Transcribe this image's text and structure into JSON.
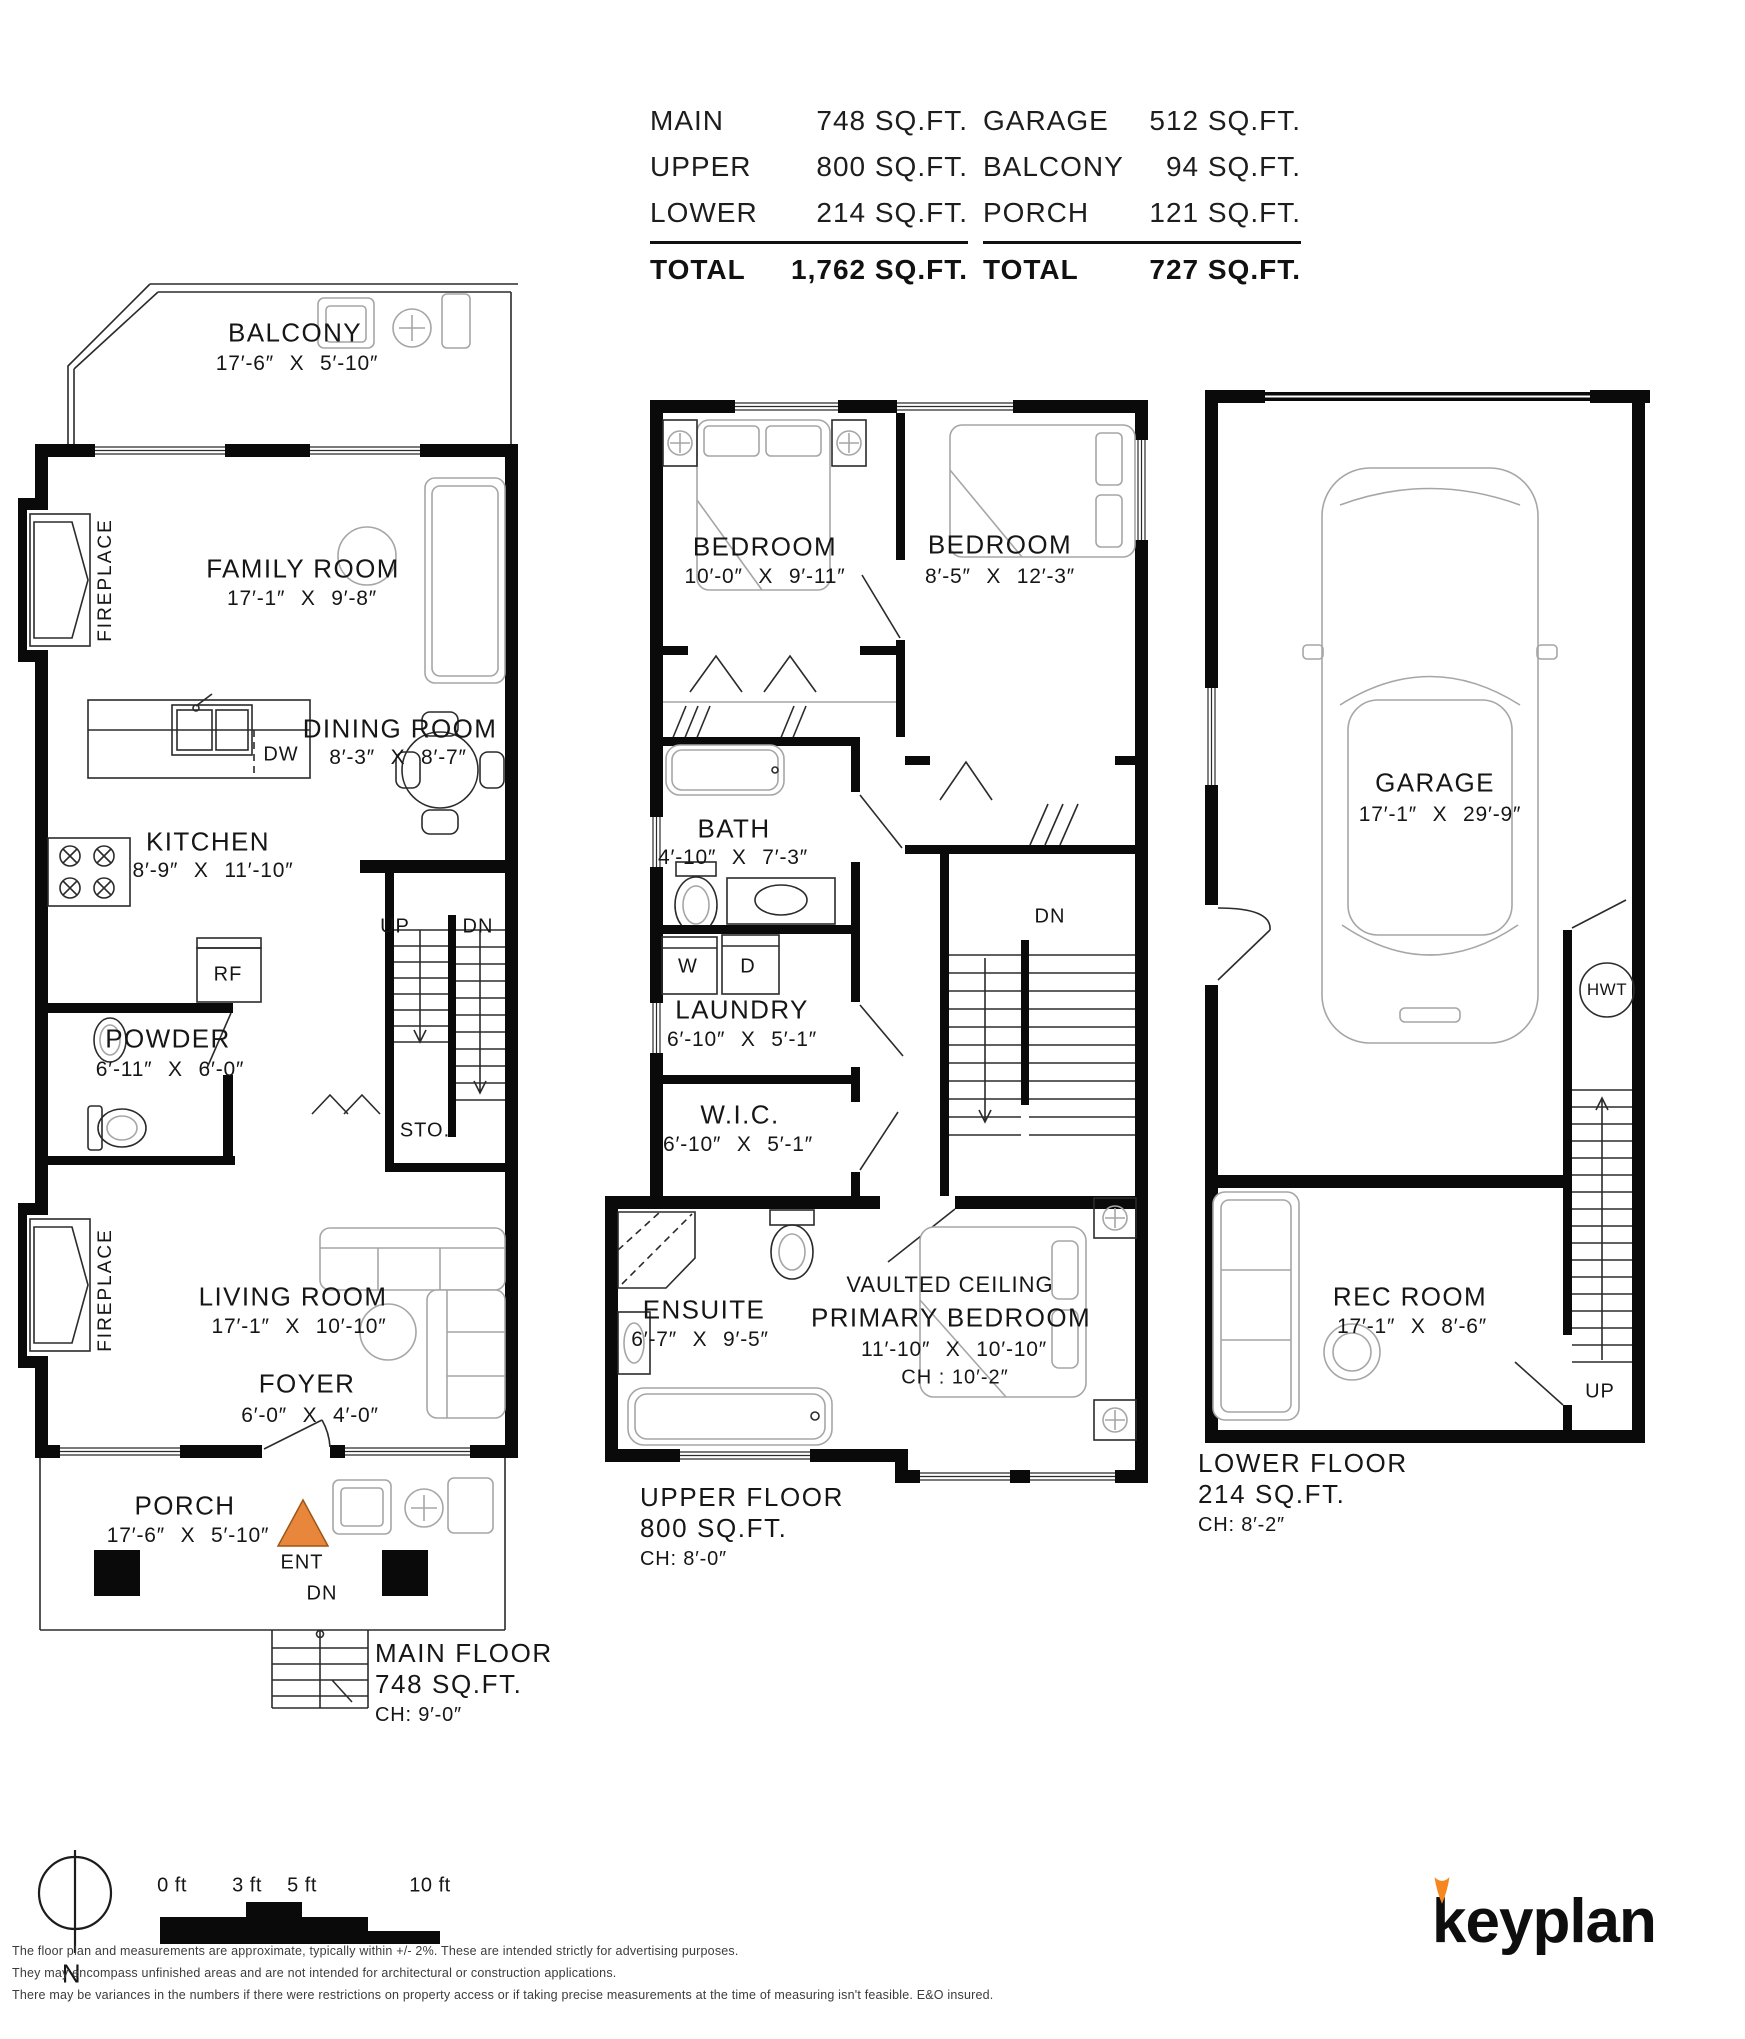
{
  "colors": {
    "accent_orange": "#E8873B",
    "flame_orange": "#F6861F"
  },
  "summary": {
    "left": {
      "rows": [
        {
          "label": "MAIN",
          "value": "748 SQ.FT."
        },
        {
          "label": "UPPER",
          "value": "800 SQ.FT."
        },
        {
          "label": "LOWER",
          "value": "214 SQ.FT."
        }
      ],
      "total_label": "TOTAL",
      "total_value": "1,762 SQ.FT."
    },
    "right": {
      "rows": [
        {
          "label": "GARAGE",
          "value": "512 SQ.FT."
        },
        {
          "label": "BALCONY",
          "value": "94 SQ.FT."
        },
        {
          "label": "PORCH",
          "value": "121 SQ.FT."
        }
      ],
      "total_label": "TOTAL",
      "total_value": "727 SQ.FT."
    }
  },
  "main_floor": {
    "title": "MAIN FLOOR",
    "area": "748 SQ.FT.",
    "ceiling": "CH: 9′-0″",
    "rooms": {
      "balcony": {
        "name": "BALCONY",
        "dims": "17′-6″ X 5′-10″"
      },
      "family": {
        "name": "FAMILY ROOM",
        "dims": "17′-1″ X 9′-8″"
      },
      "dining": {
        "name": "DINING ROOM",
        "dims": "8′-3″ X 8′-7″"
      },
      "kitchen": {
        "name": "KITCHEN",
        "dims": "8′-9″ X 11′-10″"
      },
      "powder": {
        "name": "POWDER",
        "dims": "6′-11″ X 6′-0″"
      },
      "living": {
        "name": "LIVING ROOM",
        "dims": "17′-1″ X 10′-10″"
      },
      "foyer": {
        "name": "FOYER",
        "dims": "6′-0″ X 4′-0″"
      },
      "porch": {
        "name": "PORCH",
        "dims": "17′-6″ X 5′-10″"
      }
    },
    "labels": {
      "fireplace": "FIREPLACE",
      "up": "UP",
      "down": "DN",
      "storage": "STO.",
      "fridge": "RF",
      "dishwasher": "DW",
      "entry": "ENT",
      "porch_down": "DN"
    }
  },
  "upper_floor": {
    "title": "UPPER FLOOR",
    "area": "800 SQ.FT.",
    "ceiling": "CH: 8′-0″",
    "rooms": {
      "bedroom_left": {
        "name": "BEDROOM",
        "dims": "10′-0″ X 9′-11″"
      },
      "bedroom_right": {
        "name": "BEDROOM",
        "dims": "8′-5″ X 12′-3″"
      },
      "bath": {
        "name": "BATH",
        "dims": "4′-10″ X 7′-3″"
      },
      "laundry": {
        "name": "LAUNDRY",
        "dims": "6′-10″ X 5′-1″"
      },
      "wic": {
        "name": "W.I.C.",
        "dims": "6′-10″ X 5′-1″"
      },
      "ensuite": {
        "name": "ENSUITE",
        "dims": "6′-7″ X 9′-5″"
      },
      "primary": {
        "note": "VAULTED CEILING",
        "name": "PRIMARY BEDROOM",
        "dims": "11′-10″ X 10′-10″",
        "ceiling": "CH : 10′-2″"
      }
    },
    "labels": {
      "washer": "W",
      "dryer": "D",
      "down": "DN"
    }
  },
  "lower_floor": {
    "title": "LOWER FLOOR",
    "area": "214 SQ.FT.",
    "ceiling": "CH: 8′-2″",
    "rooms": {
      "garage": {
        "name": "GARAGE",
        "dims": "17′-1″ X 29′-9″"
      },
      "rec_room": {
        "name": "REC ROOM",
        "dims": "17′-1″ X 8′-6″"
      }
    },
    "labels": {
      "hwt": "HWT",
      "up": "UP"
    }
  },
  "footer": {
    "north": "N",
    "scale_ticks": [
      "0 ft",
      "3 ft",
      "5 ft",
      "10 ft"
    ],
    "disclaimer": [
      "The floor plan and measurements are approximate, typically within +/- 2%. These are intended strictly for advertising purposes.",
      "They may encompass unfinished areas and are not intended for architectural or construction applications.",
      "There may be variances in the numbers if there were restrictions on property access or if taking precise measurements at the time of measuring isn't feasible. E&O insured."
    ],
    "brand": "keyplan"
  }
}
